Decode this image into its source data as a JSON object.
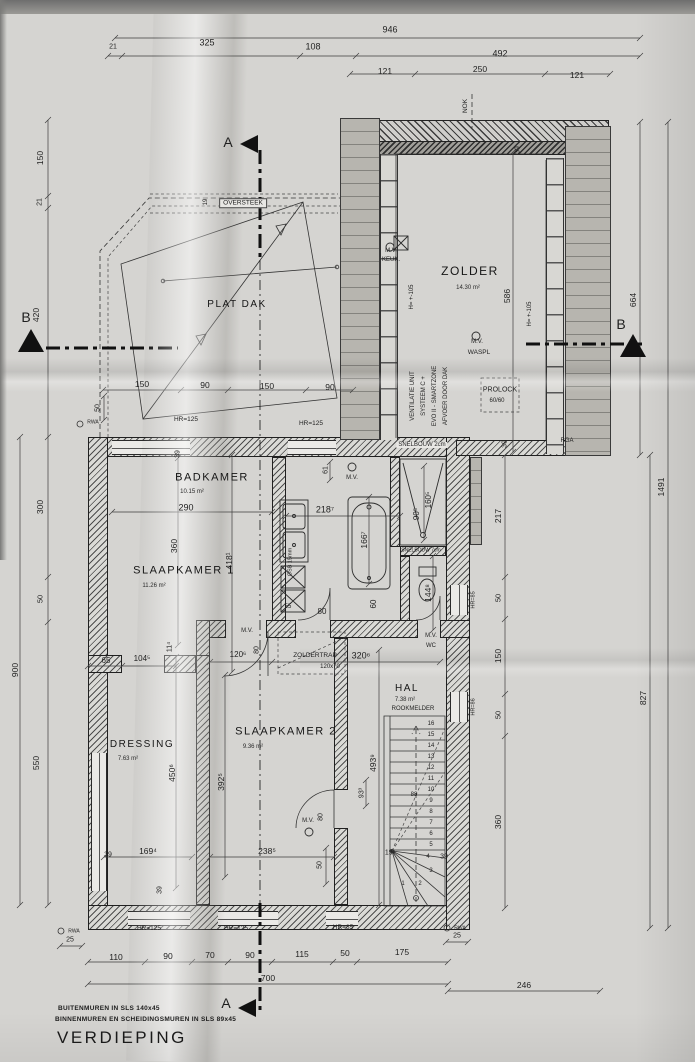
{
  "title": "VERDIEPING",
  "notes": {
    "line1": "BUITENMUREN IN SLS 140x45",
    "line2": "BINNENMUREN EN SCHEIDINGSMUREN IN SLS 89x45"
  },
  "colors": {
    "paper": "#d5d4d1",
    "ink": "#2a2a2a",
    "roof_gray": "#b7b5af"
  },
  "rooms": [
    {
      "n": "room-zolder",
      "name": "ZOLDER",
      "area": "14.30 m²",
      "x": 470,
      "y": 271,
      "s": 12,
      "ax": 468,
      "ay": 288
    },
    {
      "n": "room-plat-dak",
      "name": "PLAT DAK",
      "area": "",
      "x": 237,
      "y": 305,
      "s": 10
    },
    {
      "n": "room-badkamer",
      "name": "BADKAMER",
      "area": "10.15 m²",
      "x": 212,
      "y": 478,
      "s": 11,
      "ax": 192,
      "ay": 492
    },
    {
      "n": "room-slaapkamer-1",
      "name": "SLAAPKAMER 1",
      "area": "11.26 m²",
      "x": 184,
      "y": 571,
      "s": 11,
      "ax": 154,
      "ay": 586
    },
    {
      "n": "room-slaapkamer-2",
      "name": "SLAAPKAMER 2",
      "area": "9.36 m²",
      "x": 286,
      "y": 732,
      "s": 11,
      "ax": 253,
      "ay": 747
    },
    {
      "n": "room-dressing",
      "name": "DRESSING",
      "area": "7.63 m²",
      "x": 142,
      "y": 745,
      "s": 10,
      "ax": 128,
      "ay": 759
    },
    {
      "n": "room-hal",
      "name": "HAL",
      "area": "7.38 m²",
      "x": 407,
      "y": 689,
      "s": 10,
      "ax": 405,
      "ay": 700
    }
  ],
  "labels": [
    {
      "n": "dim-946",
      "t": "946",
      "x": 390,
      "y": 30,
      "s": 9
    },
    {
      "n": "dim-21-top",
      "t": "21",
      "x": 113,
      "y": 47,
      "s": 7
    },
    {
      "n": "dim-325",
      "t": "325",
      "x": 207,
      "y": 43,
      "s": 9
    },
    {
      "n": "dim-108",
      "t": "108",
      "x": 313,
      "y": 47,
      "s": 9
    },
    {
      "n": "dim-492",
      "t": "492",
      "x": 500,
      "y": 54,
      "s": 9
    },
    {
      "n": "dim-121-a",
      "t": "121",
      "x": 385,
      "y": 71,
      "s": 8.5
    },
    {
      "n": "dim-250",
      "t": "250",
      "x": 480,
      "y": 69,
      "s": 8.5
    },
    {
      "n": "dim-121-b",
      "t": "121",
      "x": 577,
      "y": 75,
      "s": 8.5
    },
    {
      "n": "label-nok",
      "t": "NOK",
      "x": 466,
      "y": 106,
      "s": 6.5,
      "r": -90
    },
    {
      "n": "dim-150-left",
      "t": "150",
      "x": 40,
      "y": 158,
      "s": 8.5,
      "r": -90
    },
    {
      "n": "dim-21-left",
      "t": "21",
      "x": 40,
      "y": 202,
      "s": 7,
      "r": -90
    },
    {
      "n": "dim-420-left",
      "t": "420",
      "x": 36,
      "y": 315,
      "s": 8.5,
      "r": -90
    },
    {
      "n": "dim-300-left",
      "t": "300",
      "x": 40,
      "y": 507,
      "s": 8.5,
      "r": -90
    },
    {
      "n": "dim-50-left",
      "t": "50",
      "x": 40,
      "y": 599,
      "s": 7.5,
      "r": -90
    },
    {
      "n": "dim-550-left",
      "t": "550",
      "x": 36,
      "y": 763,
      "s": 8.5,
      "r": -90
    },
    {
      "n": "dim-900-left",
      "t": "900",
      "x": 15,
      "y": 670,
      "s": 8.5,
      "r": -90
    },
    {
      "n": "dim-586",
      "t": "586",
      "x": 507,
      "y": 296,
      "s": 8.5,
      "r": -90
    },
    {
      "n": "dim-39-zolder-top",
      "t": "39",
      "x": 518,
      "y": 150,
      "s": 7,
      "r": -90
    },
    {
      "n": "dim-39-zolder-bot",
      "t": "39",
      "x": 505,
      "y": 444,
      "s": 7,
      "r": -90
    },
    {
      "n": "dim-217",
      "t": "217",
      "x": 498,
      "y": 516,
      "s": 8.5,
      "r": -90
    },
    {
      "n": "dim-50-right-a",
      "t": "50",
      "x": 498,
      "y": 598,
      "s": 7.5,
      "r": -90
    },
    {
      "n": "dim-150-right",
      "t": "150",
      "x": 498,
      "y": 656,
      "s": 8.5,
      "r": -90
    },
    {
      "n": "dim-50-right-b",
      "t": "50",
      "x": 498,
      "y": 715,
      "s": 7.5,
      "r": -90
    },
    {
      "n": "dim-360-right",
      "t": "360",
      "x": 498,
      "y": 822,
      "s": 8.5,
      "r": -90
    },
    {
      "n": "dim-827",
      "t": "827",
      "x": 643,
      "y": 698,
      "s": 8.5,
      "r": -90
    },
    {
      "n": "dim-1491",
      "t": "1491",
      "x": 661,
      "y": 487,
      "s": 8.5,
      "r": -90
    },
    {
      "n": "dim-664",
      "t": "664",
      "x": 633,
      "y": 300,
      "s": 8.5,
      "r": -90
    },
    {
      "n": "dim-25-left",
      "t": "25",
      "x": 70,
      "y": 940,
      "s": 7
    },
    {
      "n": "dim-25-right",
      "t": "25",
      "x": 457,
      "y": 936,
      "s": 7
    },
    {
      "n": "dim-110",
      "t": "110",
      "x": 116,
      "y": 957,
      "s": 8.5
    },
    {
      "n": "dim-90-a",
      "t": "90",
      "x": 168,
      "y": 956,
      "s": 8.5
    },
    {
      "n": "dim-70",
      "t": "70",
      "x": 210,
      "y": 955,
      "s": 8.5
    },
    {
      "n": "dim-90-b",
      "t": "90",
      "x": 250,
      "y": 955,
      "s": 8.5
    },
    {
      "n": "dim-115",
      "t": "115",
      "x": 302,
      "y": 954,
      "s": 8.5
    },
    {
      "n": "dim-50-bottom",
      "t": "50",
      "x": 345,
      "y": 953,
      "s": 8.5
    },
    {
      "n": "dim-175",
      "t": "175",
      "x": 402,
      "y": 952,
      "s": 8.5
    },
    {
      "n": "dim-700",
      "t": "700",
      "x": 268,
      "y": 978,
      "s": 8.5
    },
    {
      "n": "dim-246",
      "t": "246",
      "x": 524,
      "y": 985,
      "s": 8.5
    },
    {
      "n": "dim-150-pd-a",
      "t": "150",
      "x": 142,
      "y": 384,
      "s": 8.5
    },
    {
      "n": "dim-90-pd-a",
      "t": "90",
      "x": 205,
      "y": 385,
      "s": 8.5
    },
    {
      "n": "dim-150-pd-b",
      "t": "150",
      "x": 267,
      "y": 386,
      "s": 8.5
    },
    {
      "n": "dim-90-pd-b",
      "t": "90",
      "x": 330,
      "y": 387,
      "s": 8.5
    },
    {
      "n": "dim-50-pd",
      "t": "50",
      "x": 98,
      "y": 408,
      "s": 7,
      "r": -90
    },
    {
      "n": "label-oversteek",
      "t": "OVERSTEEK",
      "x": 243,
      "y": 203,
      "s": 6.5,
      "cls": "box"
    },
    {
      "n": "dim-19-oversteek",
      "t": "19",
      "x": 206,
      "y": 202,
      "s": 6,
      "r": -90
    },
    {
      "n": "label-hr125-a",
      "t": "HR=125",
      "x": 186,
      "y": 420,
      "s": 6.5
    },
    {
      "n": "label-hr125-b",
      "t": "HR=125",
      "x": 311,
      "y": 424,
      "s": 6.5
    },
    {
      "n": "label-mv-keuk-1",
      "t": "M.V.",
      "x": 391,
      "y": 251,
      "s": 6
    },
    {
      "n": "label-mv-keuk-2",
      "t": "KEUK.",
      "x": 391,
      "y": 260,
      "s": 6
    },
    {
      "n": "label-h105-left",
      "t": "H= +-105",
      "x": 412,
      "y": 297,
      "s": 6,
      "r": -90
    },
    {
      "n": "label-h105-right",
      "t": "H= +-105",
      "x": 530,
      "y": 314,
      "s": 6,
      "r": -90
    },
    {
      "n": "label-mv-waspl-1",
      "t": "M.V.",
      "x": 477,
      "y": 342,
      "s": 6
    },
    {
      "n": "label-mv-waspl-2",
      "t": "WASPL",
      "x": 479,
      "y": 353,
      "s": 6.5
    },
    {
      "n": "label-prolock",
      "t": "PROLOCK",
      "x": 500,
      "y": 390,
      "s": 7
    },
    {
      "n": "label-prolock-size",
      "t": "60/60",
      "x": 497,
      "y": 401,
      "s": 6
    },
    {
      "n": "label-ventilatie-1",
      "t": "VENTILATIE UNIT",
      "x": 413,
      "y": 396,
      "s": 6,
      "r": -90
    },
    {
      "n": "label-ventilatie-2",
      "t": "SYSTEEM C +",
      "x": 424,
      "y": 396,
      "s": 6,
      "r": -90
    },
    {
      "n": "label-ventilatie-3",
      "t": "EVO II - SMARTZONE",
      "x": 435,
      "y": 396,
      "s": 6,
      "r": -90
    },
    {
      "n": "label-ventilatie-4",
      "t": "AFVOER DOOR DAK",
      "x": 446,
      "y": 396,
      "s": 6,
      "r": -90
    },
    {
      "n": "label-snelbouw-2cm",
      "t": "SNELBOUW 2cm",
      "x": 422,
      "y": 445,
      "s": 6,
      "cls": "bg"
    },
    {
      "n": "label-rga",
      "t": "RGA",
      "x": 567,
      "y": 441,
      "s": 6
    },
    {
      "n": "dim-61",
      "t": "61",
      "x": 326,
      "y": 470,
      "s": 7,
      "r": -90
    },
    {
      "n": "label-mv-badkamer",
      "t": "M.V.",
      "x": 352,
      "y": 478,
      "s": 6
    },
    {
      "n": "dim-218",
      "t": "218⁷",
      "x": 325,
      "y": 510,
      "s": 9
    },
    {
      "n": "dim-166-bad",
      "t": "166⁷",
      "x": 364,
      "y": 540,
      "s": 8.5,
      "r": -90
    },
    {
      "n": "dim-90-douche",
      "t": "90⁵",
      "x": 417,
      "y": 514,
      "s": 8,
      "r": -90
    },
    {
      "n": "dim-160-douche",
      "t": "160⁵",
      "x": 429,
      "y": 500,
      "s": 8,
      "r": -90
    },
    {
      "n": "dim-144-wc",
      "t": "144⁸",
      "x": 428,
      "y": 593,
      "s": 8.5,
      "r": -90
    },
    {
      "n": "dim-80-badkamer",
      "t": "80",
      "x": 322,
      "y": 612,
      "s": 8
    },
    {
      "n": "dim-60-badkamer",
      "t": "60",
      "x": 374,
      "y": 604,
      "s": 8,
      "r": -90
    },
    {
      "n": "label-osb",
      "t": "OSB 15mm",
      "x": 291,
      "y": 562,
      "s": 5.5,
      "r": -90
    },
    {
      "n": "dim-55",
      "t": "55",
      "x": 288,
      "y": 607,
      "s": 6
    },
    {
      "n": "label-snelbouw-7cm",
      "t": "SNELBOUW 7cm",
      "x": 421,
      "y": 551,
      "s": 5
    },
    {
      "n": "dim-39-sk1",
      "t": "39",
      "x": 178,
      "y": 454,
      "s": 7,
      "r": -90
    },
    {
      "n": "dim-290",
      "t": "290",
      "x": 186,
      "y": 508,
      "s": 9
    },
    {
      "n": "dim-360-sk1",
      "t": "360",
      "x": 174,
      "y": 546,
      "s": 8.5,
      "r": -90
    },
    {
      "n": "dim-418",
      "t": "418¹",
      "x": 229,
      "y": 561,
      "s": 8.5,
      "r": -90
    },
    {
      "n": "dim-11",
      "t": "11⁴",
      "x": 170,
      "y": 647,
      "s": 7,
      "r": -90
    },
    {
      "n": "dim-65",
      "t": "65",
      "x": 106,
      "y": 661,
      "s": 8
    },
    {
      "n": "dim-104",
      "t": "104⁵",
      "x": 142,
      "y": 659,
      "s": 8
    },
    {
      "n": "dim-120",
      "t": "120⁶",
      "x": 238,
      "y": 655,
      "s": 8
    },
    {
      "n": "label-mv-sk1",
      "t": "M.V.",
      "x": 247,
      "y": 631,
      "s": 6
    },
    {
      "n": "dim-80-sk1",
      "t": "80",
      "x": 257,
      "y": 650,
      "s": 7,
      "r": -90
    },
    {
      "n": "label-zoldertrap",
      "t": "ZOLDERTRAP",
      "x": 315,
      "y": 656,
      "s": 6.5
    },
    {
      "n": "label-zoldertrap-size",
      "t": "120x70",
      "x": 330,
      "y": 667,
      "s": 6
    },
    {
      "n": "dim-320",
      "t": "320⁶",
      "x": 361,
      "y": 656,
      "s": 9
    },
    {
      "n": "label-mv-wc-1",
      "t": "M.V.",
      "x": 431,
      "y": 636,
      "s": 6
    },
    {
      "n": "label-mv-wc-2",
      "t": "WC",
      "x": 431,
      "y": 646,
      "s": 6
    },
    {
      "n": "label-rookmelder",
      "t": "ROOKMELDER",
      "x": 413,
      "y": 709,
      "s": 6
    },
    {
      "n": "label-hr86-hal",
      "t": "HR=86",
      "x": 474,
      "y": 707,
      "s": 5.5,
      "r": -90
    },
    {
      "n": "label-hr85-right",
      "t": "HR=85",
      "x": 474,
      "y": 600,
      "s": 5.5,
      "r": -90
    },
    {
      "n": "dim-19-trap",
      "t": "19⁷",
      "x": 390,
      "y": 853,
      "s": 7
    },
    {
      "n": "dim-39-trap",
      "t": "39",
      "x": 444,
      "y": 857,
      "s": 7
    },
    {
      "n": "dim-88",
      "t": "88",
      "x": 414,
      "y": 795,
      "s": 6
    },
    {
      "n": "dim-493",
      "t": "493⁹",
      "x": 373,
      "y": 763,
      "s": 8.5,
      "r": -90
    },
    {
      "n": "dim-93",
      "t": "93³",
      "x": 362,
      "y": 793,
      "s": 7,
      "r": -90
    },
    {
      "n": "dim-50-sk2-deur",
      "t": "50",
      "x": 320,
      "y": 865,
      "s": 7,
      "r": -90
    },
    {
      "n": "dim-450",
      "t": "450⁶",
      "x": 172,
      "y": 773,
      "s": 8.5,
      "r": -90
    },
    {
      "n": "dim-169",
      "t": "169⁴",
      "x": 148,
      "y": 851,
      "s": 8.5
    },
    {
      "n": "dim-39-dressing-a",
      "t": "39",
      "x": 108,
      "y": 855,
      "s": 7
    },
    {
      "n": "dim-39-dressing-b",
      "t": "39",
      "x": 160,
      "y": 890,
      "s": 7,
      "r": -90
    },
    {
      "n": "dim-392",
      "t": "392⁵",
      "x": 221,
      "y": 782,
      "s": 8.5,
      "r": -90
    },
    {
      "n": "dim-238",
      "t": "238⁵",
      "x": 267,
      "y": 851,
      "s": 8.5
    },
    {
      "n": "label-mv-sk2",
      "t": "M.V.",
      "x": 308,
      "y": 821,
      "s": 6
    },
    {
      "n": "dim-80-sk2",
      "t": "80",
      "x": 321,
      "y": 817,
      "s": 7,
      "r": -90
    },
    {
      "n": "label-hr125-c",
      "t": "HR=125",
      "x": 149,
      "y": 929,
      "s": 6.5
    },
    {
      "n": "label-hr125-d",
      "t": "HR=125",
      "x": 236,
      "y": 929,
      "s": 6.5
    },
    {
      "n": "label-hr85-bottom",
      "t": "HR=85",
      "x": 343,
      "y": 928,
      "s": 6.5
    },
    {
      "n": "label-rwa-1",
      "t": "RWA",
      "x": 93,
      "y": 423,
      "s": 5
    },
    {
      "n": "label-rwa-2",
      "t": "RWA",
      "x": 74,
      "y": 932,
      "s": 5
    },
    {
      "n": "label-rwa-3",
      "t": "RWA",
      "x": 460,
      "y": 929,
      "s": 5
    },
    {
      "n": "label-section-a-top",
      "t": "A",
      "x": 228,
      "y": 142,
      "s": 14
    },
    {
      "n": "label-section-a-bottom",
      "t": "A",
      "x": 226,
      "y": 1003,
      "s": 14
    },
    {
      "n": "label-section-b-left",
      "t": "B",
      "x": 26,
      "y": 317,
      "s": 14
    },
    {
      "n": "label-section-b-right",
      "t": "B",
      "x": 621,
      "y": 324,
      "s": 14
    },
    {
      "n": "stair-step-16",
      "t": "16",
      "x": 431,
      "y": 724,
      "s": 6
    },
    {
      "n": "stair-step-15",
      "t": "15",
      "x": 431,
      "y": 735,
      "s": 6
    },
    {
      "n": "stair-step-14",
      "t": "14",
      "x": 431,
      "y": 746,
      "s": 6
    },
    {
      "n": "stair-step-13",
      "t": "13",
      "x": 431,
      "y": 757,
      "s": 6
    },
    {
      "n": "stair-step-12",
      "t": "12",
      "x": 431,
      "y": 768,
      "s": 6
    },
    {
      "n": "stair-step-11",
      "t": "11",
      "x": 431,
      "y": 779,
      "s": 6
    },
    {
      "n": "stair-step-10",
      "t": "10",
      "x": 431,
      "y": 790,
      "s": 6
    },
    {
      "n": "stair-step-9",
      "t": "9",
      "x": 431,
      "y": 801,
      "s": 6
    },
    {
      "n": "stair-step-8",
      "t": "8",
      "x": 431,
      "y": 812,
      "s": 6
    },
    {
      "n": "stair-step-7",
      "t": "7",
      "x": 431,
      "y": 823,
      "s": 6
    },
    {
      "n": "stair-step-6",
      "t": "6",
      "x": 431,
      "y": 834,
      "s": 6
    },
    {
      "n": "stair-step-5",
      "t": "5",
      "x": 431,
      "y": 845,
      "s": 6
    },
    {
      "n": "stair-step-4",
      "t": "4",
      "x": 428,
      "y": 857,
      "s": 6
    },
    {
      "n": "stair-step-3",
      "t": "3",
      "x": 431,
      "y": 871,
      "s": 6
    },
    {
      "n": "stair-step-2",
      "t": "2",
      "x": 420,
      "y": 884,
      "s": 6
    },
    {
      "n": "stair-step-1",
      "t": "1",
      "x": 403,
      "y": 884,
      "s": 6
    }
  ]
}
